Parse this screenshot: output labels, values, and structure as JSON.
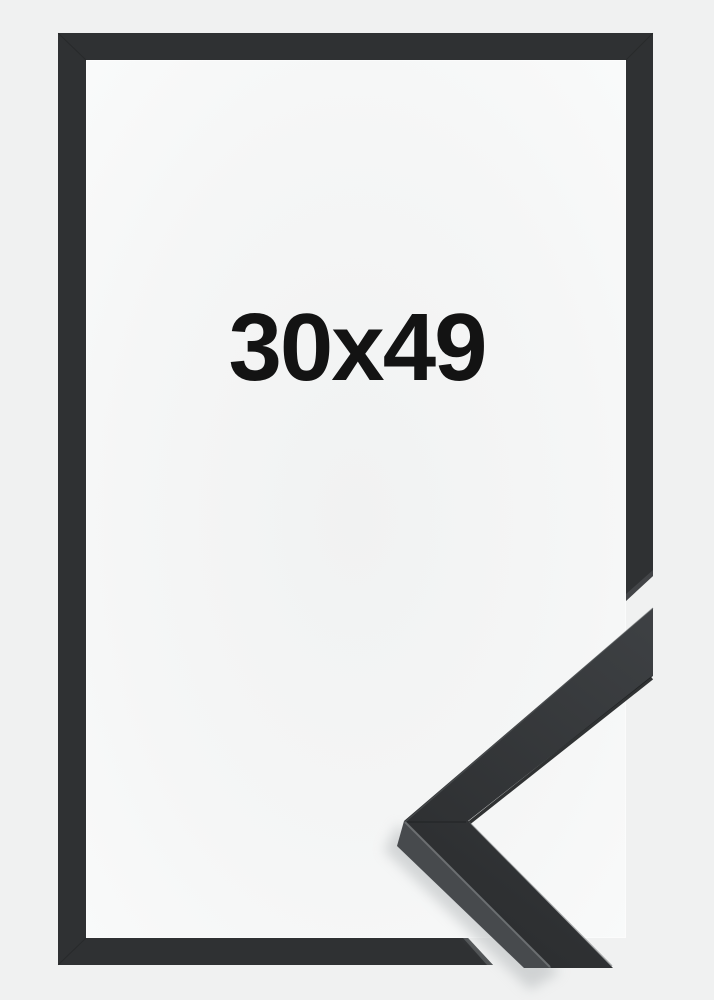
{
  "product": {
    "size_label": "30x49"
  },
  "colors": {
    "background": "#f0f1f1",
    "paper_center": "#f1f2f2",
    "paper_mid": "#f5f6f6",
    "paper_edge": "#fafbfb",
    "frame": "#2f3133",
    "frame_face_light": "#3f4245",
    "frame_face_dark": "#2c2e30",
    "frame_side": "#474a4d",
    "miter_face": "#55585b",
    "edge_highlight": "#707376",
    "edge_mid": "#5a5d60",
    "edge_shadow": "#1b1d1e",
    "shadow": "#b6babc",
    "text": "#131313"
  }
}
